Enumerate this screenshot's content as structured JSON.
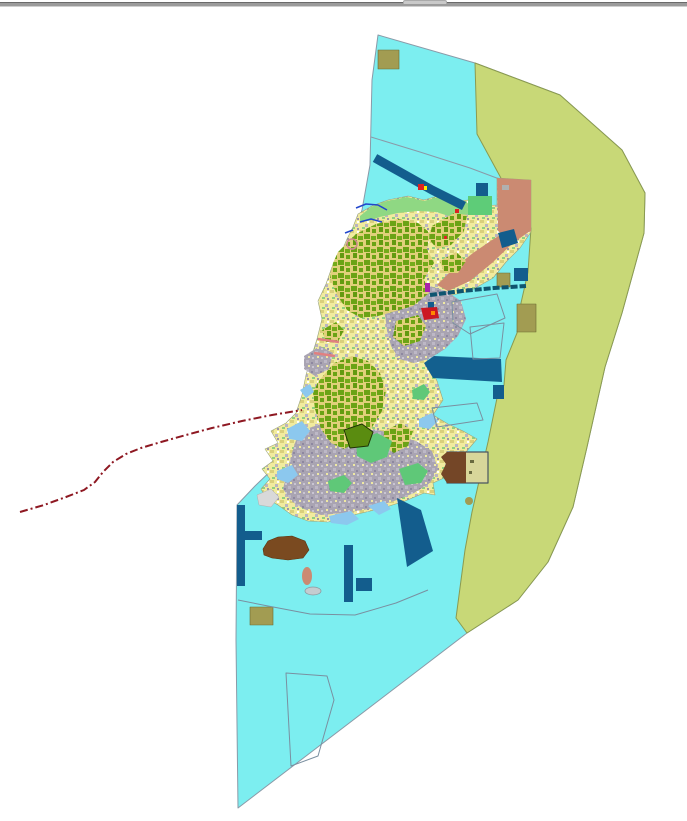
{
  "window": {
    "divider_color": "#9b9b9b",
    "splitter_handle_color": "#c9c9c9"
  },
  "map": {
    "width": 687,
    "height": 821,
    "background": "#ffffff",
    "palette": {
      "coastal_water": "#7ceef0",
      "offshore_zone": "#c8d877",
      "island_base": "#f1eb9e",
      "forest": "#6ba315",
      "urban": "#a9a4b2",
      "harbor_navy": "#135d8d",
      "military_khaki": "#a29c52",
      "developed_salmon": "#cb8a72",
      "coastal_green": "#8fd883",
      "bright_green": "#5ecc78",
      "shallow_lightblue": "#8cc8ee",
      "brown_area": "#7a4a20",
      "boundary_line_red": "#8e1822",
      "stream_blue": "#2247cc",
      "parcel_stroke": "#7a8fa0"
    },
    "patterns": [
      {
        "id": "mixTex",
        "size": 10,
        "bg": "#f1eb9e",
        "specks": [
          [
            0,
            0,
            4,
            3,
            "#d9cf7c"
          ],
          [
            5,
            4,
            3,
            3,
            "#b9b4c0"
          ],
          [
            2,
            7,
            3,
            2,
            "#90d080"
          ],
          [
            7,
            1,
            2,
            2,
            "#ffffff"
          ],
          [
            7,
            8,
            2,
            2,
            "#9a94a8"
          ]
        ]
      },
      {
        "id": "forestTex",
        "size": 13,
        "bg": "#e0d07a",
        "specks": [
          [
            0,
            0,
            6,
            5,
            "#6ba315"
          ],
          [
            7,
            2,
            5,
            4,
            "#74ab1a"
          ],
          [
            2,
            6,
            4,
            5,
            "#639a10"
          ],
          [
            8,
            8,
            4,
            4,
            "#6ba315"
          ]
        ]
      },
      {
        "id": "urbanTex",
        "size": 9,
        "bg": "#a9a4b2",
        "specks": [
          [
            0,
            0,
            3,
            3,
            "#bdb8c6"
          ],
          [
            5,
            2,
            2,
            2,
            "#8e88a0"
          ],
          [
            2,
            5,
            2,
            2,
            "#efe9a2"
          ],
          [
            6,
            6,
            2,
            2,
            "#c9c5d2"
          ]
        ]
      }
    ],
    "features": [
      {
        "kind": "polygon",
        "name": "coastal-water-zone",
        "fill": "#7ceef0",
        "stroke": "#8a9aa8",
        "sw": 1,
        "points": "378,35 475,63 560,95 622,150 645,193 644,233 622,313 605,367 587,447 573,507 548,562 518,600 467,633 238,808 236,640 237,505 255,486 280,462 300,430 310,380 320,330 335,285 350,245 362,210 370,165 372,80"
      },
      {
        "kind": "polygon",
        "name": "offshore-zone",
        "fill": "#c8d877",
        "stroke": "#8a9a50",
        "sw": 1,
        "points": "475,63 560,95 622,150 645,193 644,233 622,313 605,367 587,447 573,507 548,562 518,600 467,633 456,618 465,550 472,512 488,442 497,398 504,385 506,360 517,333 521,303 528,272 531,228 513,213 504,193 502,180 477,134"
      },
      {
        "kind": "polyline",
        "name": "water-zone-boundary-line",
        "stroke": "#8a9aa8",
        "sw": 1,
        "points": "371,137 420,152 470,168 502,180"
      },
      {
        "kind": "polygon",
        "name": "island-landmass",
        "fill": "url(#mixTex)",
        "stroke": "#9aa37a",
        "sw": 0.6,
        "points": "358,214 372,206 388,200 408,196 424,200 438,196 452,202 468,200 482,206 497,205 497,178 531,180 531,232 520,248 506,262 493,278 470,291 448,296 431,295 439,311 444,330 431,345 427,361 437,381 443,400 433,415 448,424 463,431 477,439 466,452 448,459 446,477 433,483 435,495 424,493 405,501 383,508 362,513 345,517 328,522 308,521 292,515 278,505 266,498 261,489 270,479 262,469 273,461 265,449 278,443 271,431 286,423 296,413 302,395 306,375 312,355 317,339 322,319 318,301 326,284 332,267 341,253 347,239 353,227"
      },
      {
        "kind": "polygon",
        "name": "north-coast-green-strip",
        "fill": "#8fd883",
        "points": "360,216 371,207 387,201 407,197 424,201 438,197 452,203 466,201 471,208 470,214 452,217 436,212 418,211 398,213 380,217 368,221 360,221"
      },
      {
        "kind": "polygon",
        "name": "salmon-developed-area-north",
        "fill": "#cb8a72",
        "points": "497,178 531,180 531,231 513,240 498,231"
      },
      {
        "kind": "polygon",
        "name": "salmon-developed-band",
        "fill": "#cb8a72",
        "points": "530,231 513,243 492,263 470,281 448,291 437,285 452,270 473,253 492,240 512,228"
      },
      {
        "kind": "polygon",
        "name": "urban-area-central",
        "fill": "url(#urbanTex)",
        "points": "390,291 420,283 446,291 461,301 466,319 458,336 445,349 429,359 414,363 399,359 391,346 387,331 385,313"
      },
      {
        "kind": "polygon",
        "name": "urban-area-south",
        "fill": "url(#urbanTex)",
        "points": "300,431 330,421 360,426 390,433 416,441 432,451 438,469 430,483 414,493 394,501 369,509 344,513 321,515 304,509 291,501 283,489 287,473 291,456 295,443"
      },
      {
        "kind": "polygon",
        "name": "urban-area-west",
        "fill": "url(#urbanTex)",
        "points": "304,356 320,346 333,353 329,369 315,376 304,369"
      },
      {
        "kind": "polygon",
        "name": "forest-area-north",
        "fill": "url(#forestTex)",
        "points": "338,252 356,234 376,224 398,219 418,223 430,233 427,249 434,263 424,279 429,293 413,306 396,311 378,316 361,318 347,310 337,295 330,278 333,263"
      },
      {
        "kind": "polygon",
        "name": "forest-area-northeast",
        "fill": "url(#forestTex)",
        "points": "432,226 454,213 467,215 464,231 451,245 437,249 429,239"
      },
      {
        "kind": "polygon",
        "name": "forest-area-east",
        "fill": "url(#forestTex)",
        "points": "440,261 456,252 466,261 458,273 444,273"
      },
      {
        "kind": "polygon",
        "name": "forest-area-midnorth",
        "fill": "url(#forestTex)",
        "points": "396,321 418,315 426,326 420,341 404,346 393,337"
      },
      {
        "kind": "polygon",
        "name": "forest-area-central",
        "fill": "url(#forestTex)",
        "points": "318,382 334,363 352,356 368,361 380,373 386,391 382,411 371,429 359,441 344,449 331,443 321,429 315,409 313,393"
      },
      {
        "kind": "polygon",
        "name": "forest-area-southcentral",
        "fill": "url(#forestTex)",
        "points": "384,431 401,423 413,431 408,446 394,453 383,446"
      },
      {
        "kind": "polygon",
        "name": "forest-area-west",
        "fill": "url(#forestTex)",
        "points": "322,330 336,322 344,330 338,342 326,342"
      },
      {
        "kind": "polygon",
        "name": "green-patch-1",
        "fill": "#5fc878",
        "points": "356,441 377,433 392,441 387,457 371,463 357,456"
      },
      {
        "kind": "polygon",
        "name": "green-patch-2",
        "fill": "#5fc878",
        "points": "399,469 418,463 428,471 421,483 405,485"
      },
      {
        "kind": "polygon",
        "name": "green-patch-3",
        "fill": "#5fc878",
        "points": "328,481 344,475 352,483 344,493 330,491"
      },
      {
        "kind": "polygon",
        "name": "green-patch-4",
        "fill": "#5fc878",
        "points": "412,390 424,384 430,392 424,400 413,399"
      },
      {
        "kind": "polygon",
        "name": "bordered-park-polygon",
        "fill": "#5a8c10",
        "stroke": "#1e3305",
        "sw": 1,
        "points": "344,430 362,424 373,432 368,446 350,448"
      },
      {
        "kind": "polygon",
        "name": "shallow-water-patch-1",
        "fill": "#8cc8ee",
        "points": "287,429 302,421 310,431 302,441 289,439"
      },
      {
        "kind": "polygon",
        "name": "shallow-water-patch-2",
        "fill": "#8cc8ee",
        "points": "277,471 292,465 298,475 288,483 277,479"
      },
      {
        "kind": "polygon",
        "name": "shallow-water-patch-3",
        "fill": "#8cc8ee",
        "points": "329,516 351,511 359,519 347,525 331,523"
      },
      {
        "kind": "polygon",
        "name": "shallow-water-patch-4",
        "fill": "#8cc8ee",
        "points": "419,419 432,413 438,421 430,429 419,427"
      },
      {
        "kind": "polygon",
        "name": "shallow-water-patch-5",
        "fill": "#8cc8ee",
        "points": "368,506 384,501 391,509 379,515"
      },
      {
        "kind": "polygon",
        "name": "shallow-water-patch-6",
        "fill": "#8cc8ee",
        "points": "300,390 310,384 314,392 306,398"
      },
      {
        "kind": "polygon",
        "name": "gray-flat-area",
        "fill": "#d9d9d9",
        "stroke": "#b0b0b0",
        "sw": 0.5,
        "points": "257,495 271,489 279,497 271,507 259,505"
      },
      {
        "kind": "rect",
        "name": "bright-green-parcel",
        "fill": "#5ecc78",
        "x": 468,
        "y": 196,
        "w": 24,
        "h": 19
      },
      {
        "kind": "rect",
        "name": "navy-parcel-northeast",
        "fill": "#135d8d",
        "x": 476,
        "y": 183,
        "w": 12,
        "h": 13
      },
      {
        "kind": "rect",
        "name": "gray-parcel-northeast",
        "fill": "#b0b0b0",
        "x": 502,
        "y": 185,
        "w": 7,
        "h": 5
      },
      {
        "kind": "polyline",
        "name": "navy-channel-band",
        "stroke": "#135d8d",
        "sw": 9,
        "points": "375,158 400,172 432,190 464,206"
      },
      {
        "kind": "polygon",
        "name": "navy-parcel-diagonal",
        "fill": "#135d8d",
        "points": "498,233 514,229 518,243 502,248"
      },
      {
        "kind": "rect",
        "name": "navy-square-offshore",
        "fill": "#135d8d",
        "x": 514,
        "y": 268,
        "w": 14,
        "h": 13
      },
      {
        "kind": "polygon",
        "name": "harbor-bay-polygon",
        "fill": "#13608f",
        "points": "424,363 434,356 501,359 502,382 433,378"
      },
      {
        "kind": "rect",
        "name": "navy-square-bay",
        "fill": "#135d8d",
        "x": 493,
        "y": 385,
        "w": 11,
        "h": 14
      },
      {
        "kind": "polygon",
        "name": "harbor-pier-band-south",
        "fill": "#135d8d",
        "points": "397,498 421,510 433,551 407,567"
      },
      {
        "kind": "rect",
        "name": "navy-strip-south",
        "fill": "#135d8d",
        "x": 344,
        "y": 545,
        "w": 9,
        "h": 57
      },
      {
        "kind": "rect",
        "name": "navy-square-south",
        "fill": "#135d8d",
        "x": 356,
        "y": 578,
        "w": 16,
        "h": 13
      },
      {
        "kind": "rect",
        "name": "navy-breakwater-vertical",
        "fill": "#135d8d",
        "x": 237,
        "y": 505,
        "w": 8,
        "h": 81
      },
      {
        "kind": "rect",
        "name": "navy-breakwater-arm",
        "fill": "#135d8d",
        "x": 245,
        "y": 531,
        "w": 17,
        "h": 9
      },
      {
        "kind": "rect",
        "name": "navy-dock-tick",
        "fill": "#135d8d",
        "x": 428,
        "y": 302,
        "w": 6,
        "h": 6
      },
      {
        "kind": "rect",
        "name": "khaki-parcel-top",
        "fill": "#a29c52",
        "stroke": "#6a6a30",
        "sw": 0.6,
        "x": 378,
        "y": 50,
        "w": 21,
        "h": 19
      },
      {
        "kind": "rect",
        "name": "khaki-square-offshore",
        "fill": "#a29c52",
        "stroke": "#6a6a30",
        "sw": 0.6,
        "x": 497,
        "y": 273,
        "w": 13,
        "h": 14
      },
      {
        "kind": "rect",
        "name": "khaki-rect-boundary",
        "fill": "#a29c52",
        "stroke": "#6a6a30",
        "sw": 0.6,
        "x": 517,
        "y": 304,
        "w": 19,
        "h": 28
      },
      {
        "kind": "rect",
        "name": "khaki-rect-south",
        "fill": "#a29c52",
        "stroke": "#6a6a30",
        "sw": 0.6,
        "x": 250,
        "y": 607,
        "w": 23,
        "h": 18
      },
      {
        "kind": "ellipse",
        "name": "khaki-dot",
        "fill": "#a29c52",
        "cx": 469,
        "cy": 501,
        "rx": 4,
        "ry": 4
      },
      {
        "kind": "polygon",
        "name": "brown-area-southwest",
        "fill": "#7a4a20",
        "stroke": "#5a330f",
        "sw": 0.6,
        "points": "263,549 268,541 278,537 292,536 305,541 309,550 303,558 288,560 272,558 264,555"
      },
      {
        "kind": "ellipse",
        "name": "salmon-islet",
        "fill": "#cb8a72",
        "cx": 307,
        "cy": 576,
        "rx": 5,
        "ry": 9
      },
      {
        "kind": "ellipse",
        "name": "gray-islet",
        "fill": "#c4ccd0",
        "stroke": "#8a9aa0",
        "sw": 0.8,
        "cx": 313,
        "cy": 591,
        "rx": 8,
        "ry": 4
      },
      {
        "kind": "rect",
        "name": "bordered-compound-rect",
        "fill": "#d8d69a",
        "stroke": "#4a5560",
        "sw": 1.2,
        "x": 447,
        "y": 452,
        "w": 41,
        "h": 31
      },
      {
        "kind": "polygon",
        "name": "bordered-compound-brown-half",
        "fill": "#744627",
        "points": "447,452 466,452 466,483 447,483 441,474 446,464 441,457"
      },
      {
        "kind": "rect",
        "name": "compound-mark-1",
        "fill": "#6a6a40",
        "x": 470,
        "y": 460,
        "w": 4,
        "h": 3
      },
      {
        "kind": "rect",
        "name": "compound-mark-2",
        "fill": "#6a6a40",
        "x": 469,
        "y": 471,
        "w": 3,
        "h": 3
      },
      {
        "kind": "polygon",
        "name": "parcel-outline-1",
        "fill": "none",
        "stroke": "#7a8fa0",
        "sw": 1,
        "points": "452,302 497,294 505,318 470,334 453,323"
      },
      {
        "kind": "polygon",
        "name": "parcel-outline-2",
        "fill": "none",
        "stroke": "#7a8fa0",
        "sw": 1,
        "points": "470,327 504,323 500,358 473,359"
      },
      {
        "kind": "polygon",
        "name": "parcel-outline-3",
        "fill": "none",
        "stroke": "#7a8fa0",
        "sw": 1,
        "points": "432,408 477,403 483,420 437,427"
      },
      {
        "kind": "polygon",
        "name": "parcel-outline-4",
        "fill": "none",
        "stroke": "#7a8fa0",
        "sw": 1,
        "points": "286,673 327,676 334,700 318,756 291,766"
      },
      {
        "kind": "polyline",
        "name": "parcel-boundary-south",
        "stroke": "#7a8fa0",
        "sw": 1,
        "points": "238,600 268,606 310,614 355,615 396,603 428,590"
      },
      {
        "kind": "polyline",
        "name": "causeway-line",
        "stroke": "#0f5570",
        "sw": 4,
        "dash": "7 2",
        "points": "430,295 462,291 494,288 526,286"
      },
      {
        "kind": "rect",
        "name": "magenta-marker",
        "fill": "#aa22aa",
        "x": 425,
        "y": 283,
        "w": 5,
        "h": 9
      },
      {
        "kind": "polygon",
        "name": "crimson-port-marker",
        "fill": "#cc1822",
        "points": "421,308 437,307 439,318 424,320"
      },
      {
        "kind": "rect",
        "name": "orange-dot-marker",
        "fill": "#ff8800",
        "x": 431,
        "y": 311,
        "w": 4,
        "h": 4
      },
      {
        "kind": "polyline",
        "name": "stream-line-1",
        "stroke": "#2247cc",
        "sw": 1.5,
        "points": "356,208 366,204 378,205 387,210"
      },
      {
        "kind": "polyline",
        "name": "stream-line-2",
        "stroke": "#2247cc",
        "sw": 1.5,
        "points": "360,222 371,219 382,222"
      },
      {
        "kind": "polyline",
        "name": "stream-line-3",
        "stroke": "#2247cc",
        "sw": 1.5,
        "points": "345,233 353,230"
      },
      {
        "kind": "polyline",
        "name": "boundary-dashdot-red-line",
        "stroke": "#8e1822",
        "sw": 2,
        "dash": "8 3 2 3",
        "points": "20,512 44,505 66,497 84,490 95,482 103,472 113,462 126,454 141,448 161,442 186,435 212,428 242,421 272,415 302,410"
      },
      {
        "kind": "polyline",
        "name": "pink-coast-segment-1",
        "stroke": "#e08080",
        "sw": 2.5,
        "points": "318,339 339,342"
      },
      {
        "kind": "polyline",
        "name": "pink-coast-segment-2",
        "stroke": "#e08080",
        "sw": 2.5,
        "points": "314,353 335,356"
      },
      {
        "kind": "circle",
        "name": "pink-ring-marker",
        "fill": "none",
        "stroke": "#d08890",
        "sw": 1.5,
        "cx": 352,
        "cy": 244,
        "r": 5
      },
      {
        "kind": "rect",
        "name": "red-marker-north",
        "fill": "#dd2222",
        "x": 418,
        "y": 184,
        "w": 6,
        "h": 6
      },
      {
        "kind": "rect",
        "name": "yellow-marker-north",
        "fill": "#ffee00",
        "x": 424,
        "y": 186,
        "w": 3,
        "h": 4
      },
      {
        "kind": "rect",
        "name": "red-marker-northeast-1",
        "fill": "#dd2222",
        "x": 455,
        "y": 209,
        "w": 4,
        "h": 4
      },
      {
        "kind": "rect",
        "name": "red-marker-northeast-2",
        "fill": "#dd2222",
        "x": 444,
        "y": 236,
        "w": 3,
        "h": 3
      }
    ]
  }
}
